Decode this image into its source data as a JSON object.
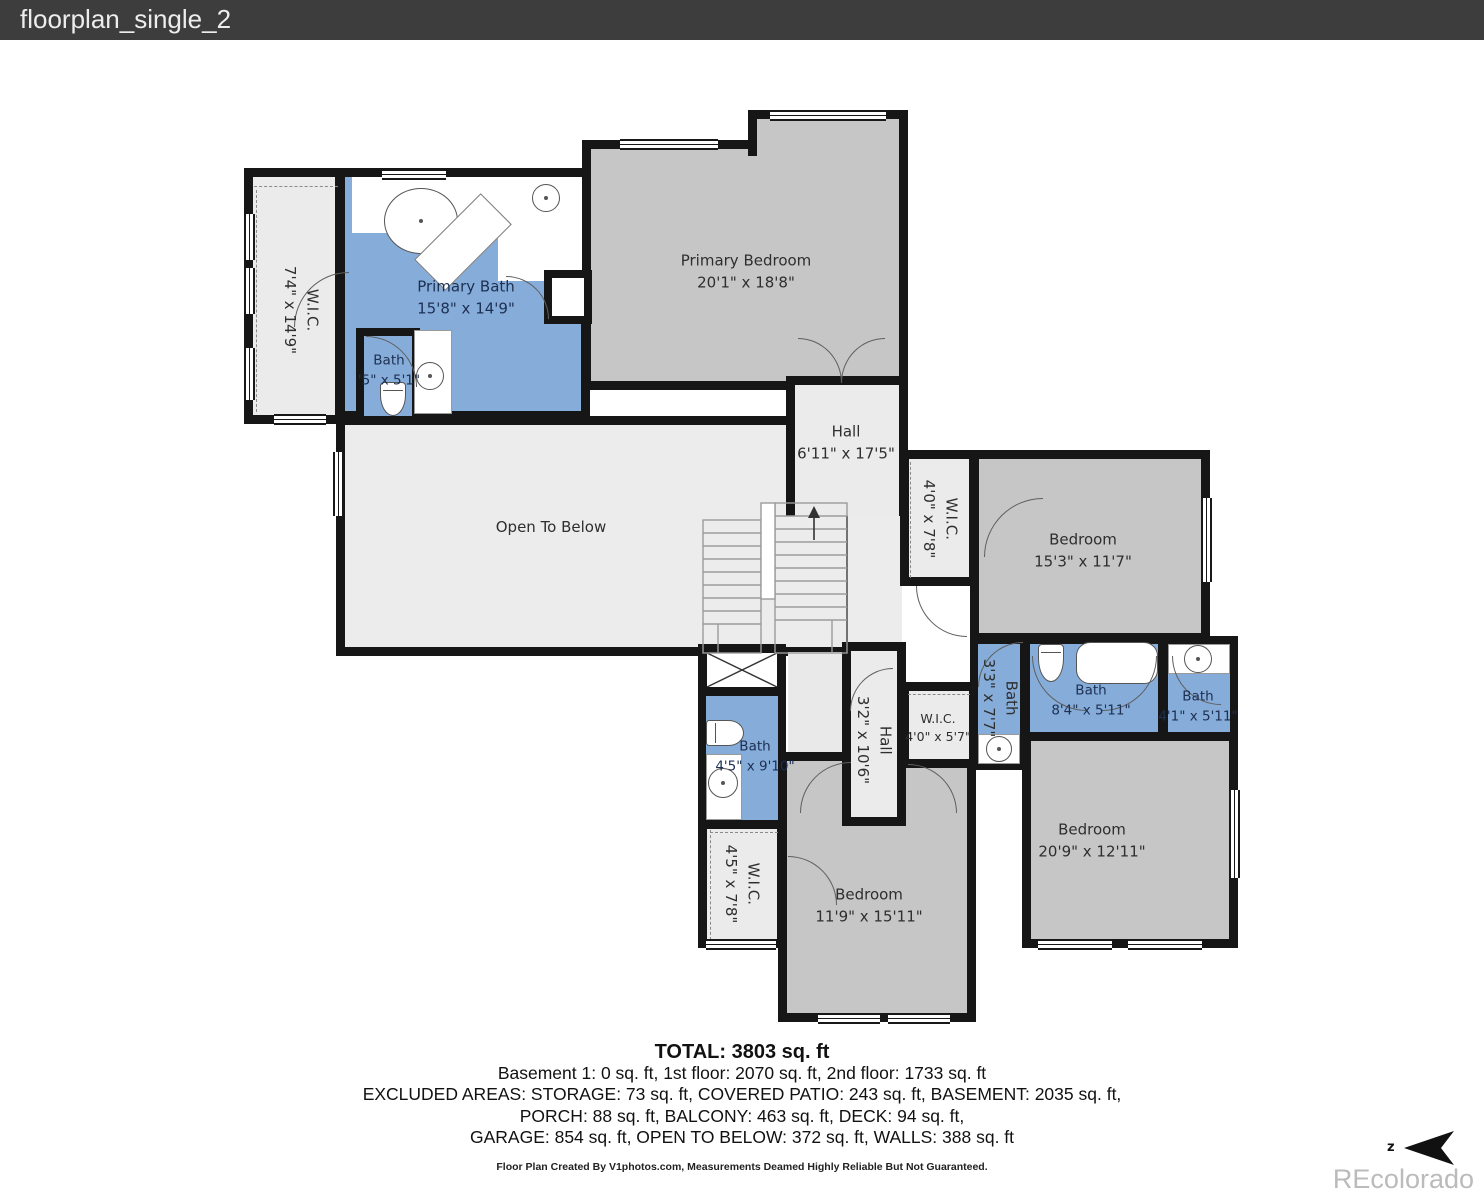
{
  "window": {
    "title": "floorplan_single_2"
  },
  "floorplan": {
    "rooms": {
      "primary_bedroom": {
        "label": "Primary Bedroom",
        "dims": "20'1\" x 18'8\""
      },
      "primary_bath": {
        "label": "Primary Bath",
        "dims": "15'8\" x 14'9\""
      },
      "wic_primary": {
        "label": "W.I.C.",
        "dims": "7'4\" x 14'9\""
      },
      "bath_toilet": {
        "label": "Bath",
        "dims": "'5\" x 5'1\""
      },
      "hall_upper": {
        "label": "Hall",
        "dims": "6'11\" x 17'5\""
      },
      "open_below": {
        "label": "Open To Below"
      },
      "wic_bed2": {
        "label": "W.I.C.",
        "dims": "4'0\" x 7'8\""
      },
      "bedroom2": {
        "label": "Bedroom",
        "dims": "15'3\" x 11'7\""
      },
      "bath_33": {
        "label": "Bath",
        "dims": "3'3\" x 7'7\""
      },
      "bath_84": {
        "label": "Bath",
        "dims": "8'4\" x 5'11\""
      },
      "bath_41": {
        "label": "Bath",
        "dims": "4'1\" x 5'11\""
      },
      "wic_57": {
        "label": "W.I.C.",
        "dims": "4'0\" x 5'7\""
      },
      "hall_lower": {
        "label": "Hall",
        "dims": "3'2\" x 10'6\""
      },
      "bath_45": {
        "label": "Bath",
        "dims": "4'5\" x 9'10\""
      },
      "wic_458": {
        "label": "W.I.C.",
        "dims": "4'5\" x 7'8\""
      },
      "bedroom3": {
        "label": "Bedroom",
        "dims": "11'9\" x 15'11\""
      },
      "bedroom4": {
        "label": "Bedroom",
        "dims": "20'9\" x 12'11\""
      }
    },
    "fixtures": [
      "oval-bathtub",
      "shower",
      "sink",
      "toilet",
      "bathtub",
      "staircase",
      "x-marked-area"
    ],
    "colors": {
      "wall": "#161616",
      "bedroom_fill": "#c6c6c6",
      "bath_fill": "#86add9",
      "hall_fill": "#ebebeb",
      "open_fill": "#ececec",
      "titlebar_bg": "#3d3d3d"
    }
  },
  "summary": {
    "total": "TOTAL: 3803 sq. ft",
    "line1": "Basement 1: 0 sq. ft, 1st floor: 2070 sq. ft, 2nd floor: 1733 sq. ft",
    "line2": "EXCLUDED AREAS: STORAGE: 73 sq. ft, COVERED PATIO: 243 sq. ft, BASEMENT: 2035 sq. ft,",
    "line3": "PORCH: 88 sq. ft, BALCONY: 463 sq. ft, DECK: 94 sq. ft,",
    "line4": "GARAGE: 854 sq. ft, OPEN TO BELOW: 372 sq. ft, WALLS: 388 sq. ft"
  },
  "footer": {
    "disclaimer": "Floor Plan Created By V1photos.com, Measurements Deamed Highly Reliable But Not Guaranteed."
  },
  "watermark": "REcolorado",
  "compass": {
    "label": "z"
  }
}
